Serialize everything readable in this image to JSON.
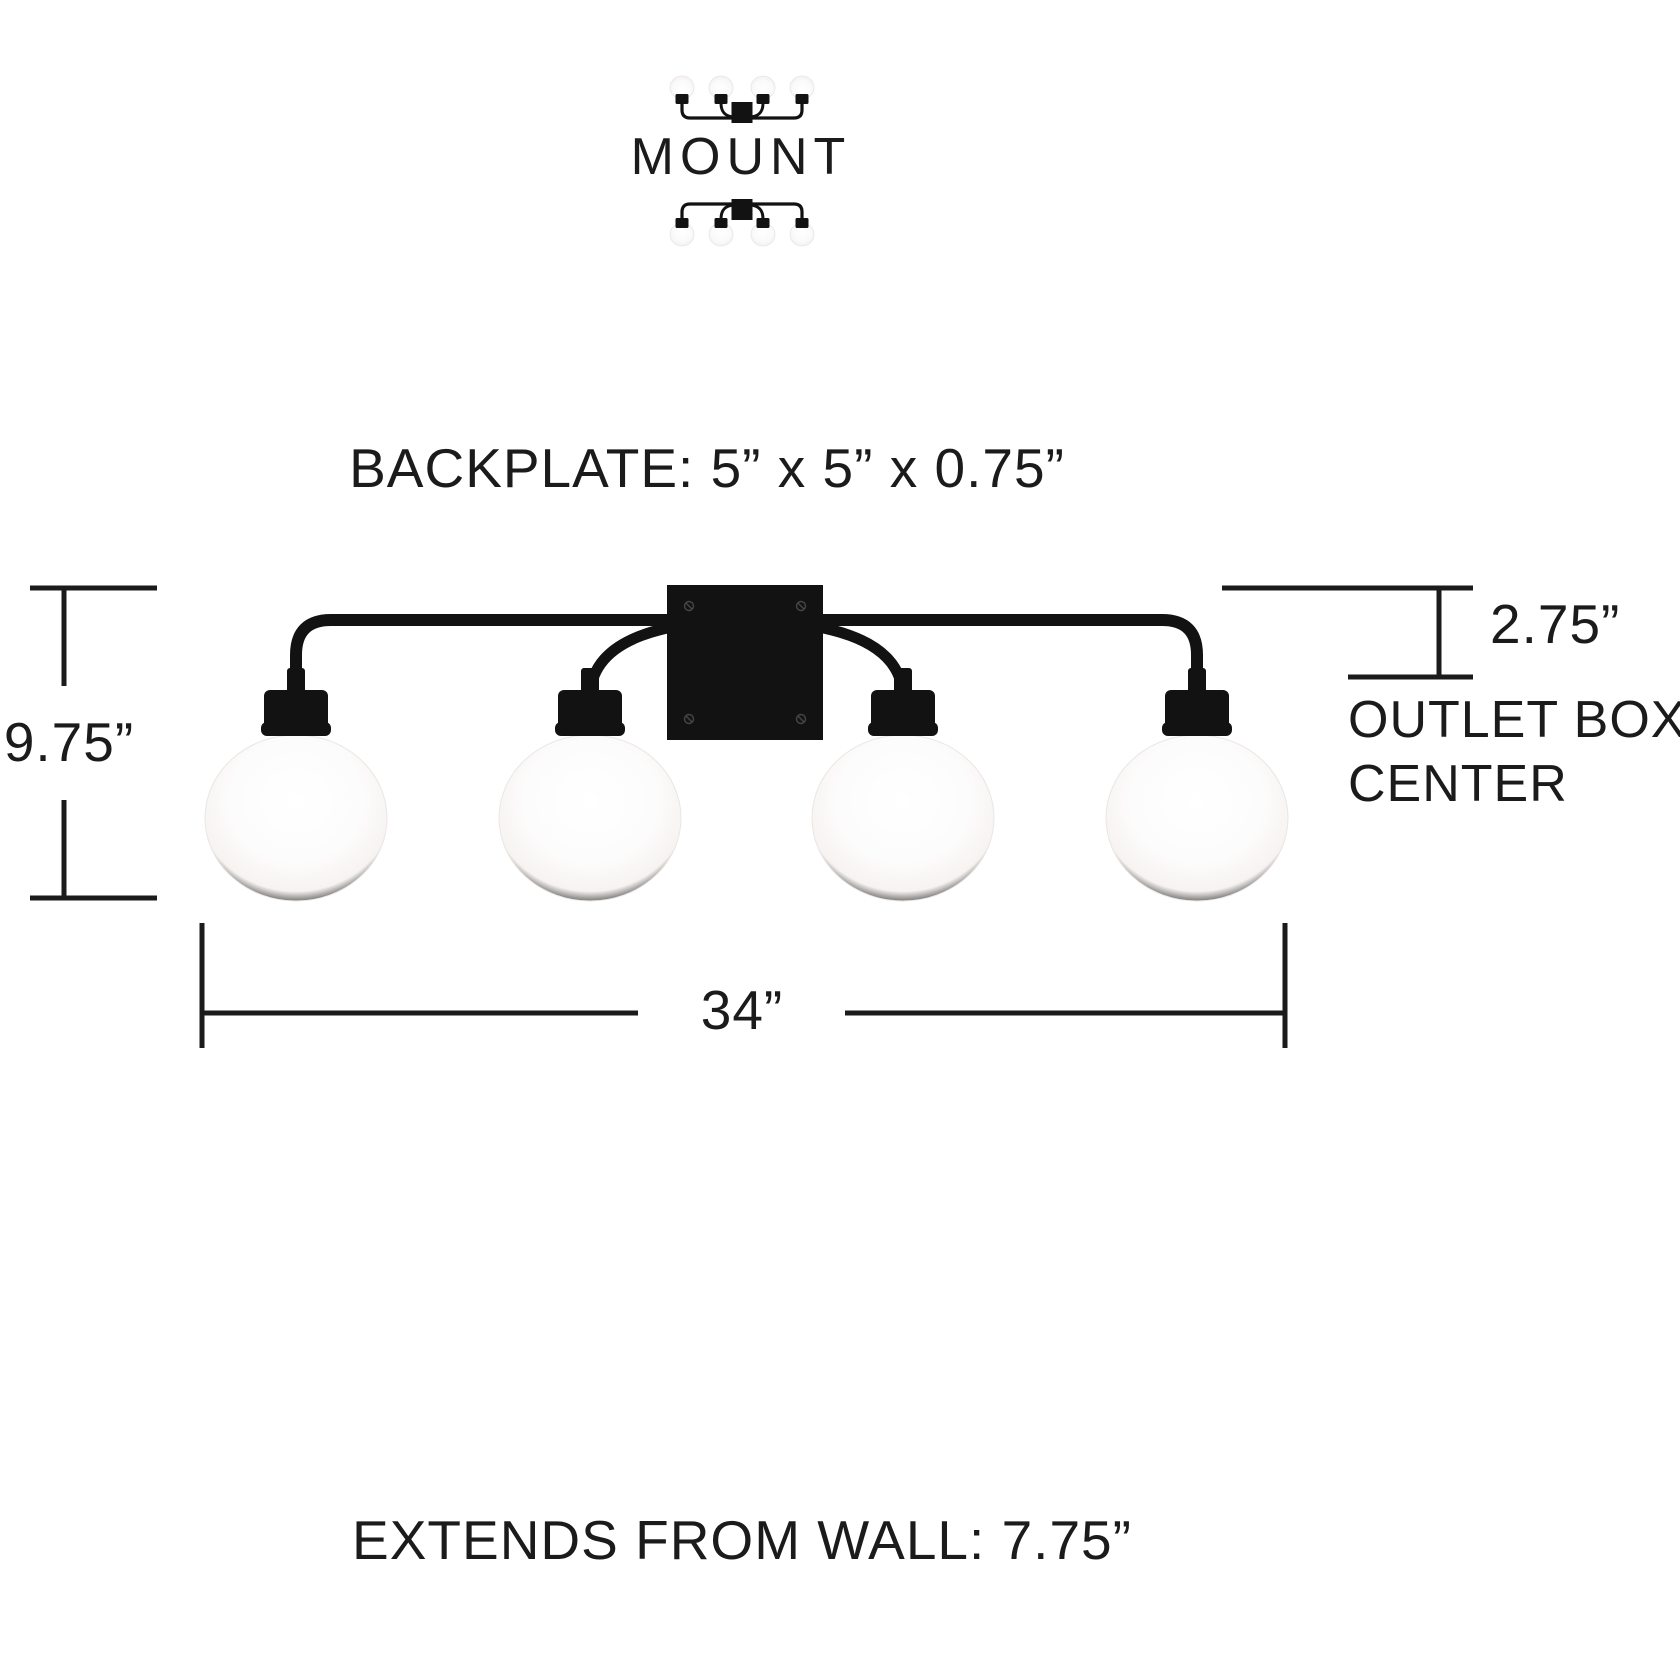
{
  "colors": {
    "ink": "#1b1b1b",
    "fixture": "#121212",
    "screw": "#464646",
    "globe_edge": "#e9e6e3",
    "background": "#ffffff"
  },
  "mount": {
    "label": "MOUNT"
  },
  "backplate": {
    "label": "BACKPLATE: 5” x 5” x 0.75”"
  },
  "fixture": {
    "light_count": 4
  },
  "dimensions": {
    "height": {
      "value": "9.75”"
    },
    "outlet_offset": {
      "value": "2.75”",
      "label_line1": "OUTLET BOX",
      "label_line2": "CENTER"
    },
    "width": {
      "value": "34”"
    },
    "wall_extension": {
      "label": "EXTENDS FROM WALL: 7.75”"
    }
  }
}
